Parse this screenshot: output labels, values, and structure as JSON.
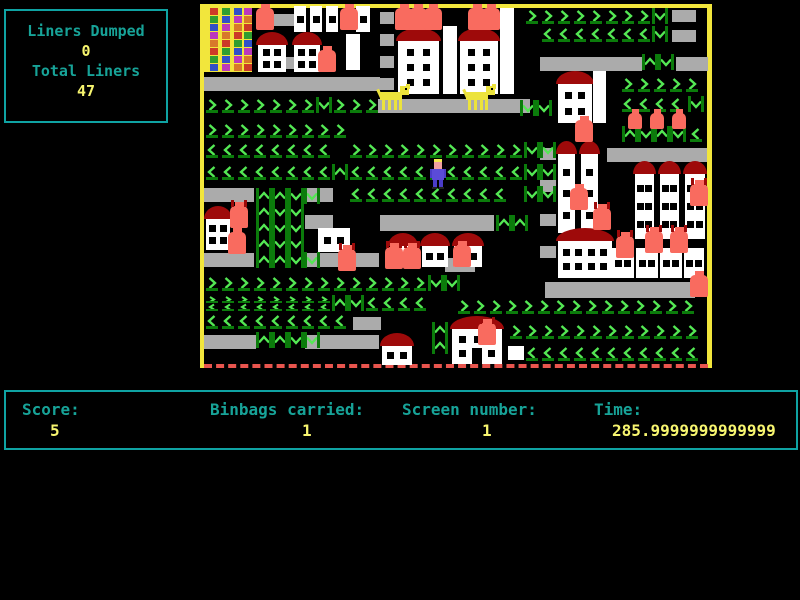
{
  "liners_panel": {
    "title": "Liners Dumped",
    "dumped": "0",
    "subtitle": "Total Liners",
    "total": "47"
  },
  "status_bar": {
    "score_label": "Score:",
    "score_value": "5",
    "binbags_label": "Binbags carried:",
    "binbags_value": "1",
    "screen_label": "Screen number:",
    "screen_value": "1",
    "time_label": "Time:",
    "time_value": "285.9999999999999"
  },
  "colors": {
    "border_yellow": "#F2E63C",
    "chevron": "#54E854",
    "chevron_dark": "#0B7B0B",
    "belt_gray": "#ABABAB",
    "house_white": "#FFFFFF",
    "roof_red": "#9E0A0A",
    "bin_salmon": "#F96B5F",
    "dog_yellow": "#ECE33C",
    "player_body": "#5B4BD8",
    "player_skin": "#F0A0A0",
    "panel_teal": "#0FA3A3",
    "label_teal": "#17A398",
    "value_yellow": "#F7F56F",
    "dash_red": "#E8554E"
  },
  "playfield": {
    "tower": {
      "x": 204,
      "y": 8,
      "w": 48,
      "h": 64,
      "block_colors": [
        "#CC3A28",
        "#2F9E30",
        "#3050C8",
        "#BC38BC",
        "#D8782A"
      ]
    },
    "belts": [
      [
        272,
        14,
        24,
        12
      ],
      [
        380,
        12,
        14,
        12
      ],
      [
        380,
        34,
        14,
        12
      ],
      [
        380,
        56,
        14,
        12
      ],
      [
        380,
        78,
        14,
        12
      ],
      [
        277,
        57,
        18,
        12
      ],
      [
        204,
        77,
        176,
        14
      ],
      [
        378,
        99,
        152,
        14
      ],
      [
        540,
        57,
        102,
        14
      ],
      [
        676,
        57,
        32,
        14
      ],
      [
        672,
        10,
        24,
        12
      ],
      [
        672,
        30,
        24,
        12
      ],
      [
        540,
        148,
        16,
        12
      ],
      [
        540,
        180,
        16,
        12
      ],
      [
        540,
        214,
        16,
        12
      ],
      [
        540,
        246,
        16,
        12
      ],
      [
        607,
        148,
        100,
        14
      ],
      [
        204,
        188,
        50,
        14
      ],
      [
        305,
        188,
        28,
        14
      ],
      [
        305,
        215,
        28,
        14
      ],
      [
        204,
        253,
        50,
        14
      ],
      [
        305,
        253,
        74,
        14
      ],
      [
        380,
        215,
        114,
        16
      ],
      [
        445,
        258,
        30,
        14
      ],
      [
        204,
        335,
        52,
        14
      ],
      [
        305,
        335,
        74,
        14
      ],
      [
        353,
        317,
        28,
        13
      ],
      [
        545,
        282,
        150,
        16
      ],
      [
        220,
        56,
        16,
        16
      ]
    ],
    "chevron_runs": [
      [
        ">",
        524,
        8,
        8
      ],
      [
        "v",
        652,
        8,
        1
      ],
      [
        "<",
        540,
        26,
        7
      ],
      [
        "v",
        652,
        26,
        1
      ],
      [
        "^",
        642,
        54,
        1
      ],
      [
        "v",
        658,
        54,
        1
      ],
      [
        ">",
        620,
        76,
        5
      ],
      [
        "<",
        620,
        96,
        4
      ],
      [
        "v",
        688,
        96,
        1
      ],
      [
        "^",
        622,
        126,
        1
      ],
      [
        "v",
        638,
        126,
        1
      ],
      [
        "^",
        654,
        126,
        1
      ],
      [
        "v",
        670,
        126,
        1
      ],
      [
        "<",
        688,
        126,
        1
      ],
      [
        ">",
        204,
        97,
        7
      ],
      [
        "v",
        316,
        97,
        1
      ],
      [
        ">",
        332,
        97,
        3
      ],
      [
        ">",
        204,
        122,
        9
      ],
      [
        "<",
        204,
        142,
        8
      ],
      [
        ">",
        348,
        142,
        11
      ],
      [
        "v",
        524,
        142,
        1
      ],
      [
        "v",
        540,
        142,
        1
      ],
      [
        "<",
        204,
        164,
        8
      ],
      [
        "^",
        332,
        164,
        1
      ],
      [
        "<",
        348,
        164,
        11
      ],
      [
        "v",
        524,
        164,
        1
      ],
      [
        "v",
        540,
        164,
        1
      ],
      [
        "<",
        348,
        186,
        10
      ],
      [
        "v",
        524,
        186,
        1
      ],
      [
        "v",
        540,
        186,
        1
      ],
      [
        "^",
        256,
        188,
        1
      ],
      [
        "^",
        272,
        188,
        1
      ],
      [
        "v",
        288,
        188,
        1
      ],
      [
        "v",
        304,
        188,
        1
      ],
      [
        "^",
        256,
        204,
        1
      ],
      [
        "v",
        272,
        204,
        1
      ],
      [
        "v",
        288,
        204,
        1
      ],
      [
        "^",
        256,
        220,
        1
      ],
      [
        "v",
        272,
        220,
        1
      ],
      [
        "v",
        288,
        220,
        1
      ],
      [
        "^",
        256,
        236,
        1
      ],
      [
        "v",
        272,
        236,
        1
      ],
      [
        "v",
        288,
        236,
        1
      ],
      [
        "^",
        256,
        252,
        1
      ],
      [
        "^",
        272,
        252,
        1
      ],
      [
        "v",
        288,
        252,
        1
      ],
      [
        "v",
        304,
        252,
        1
      ],
      [
        "^",
        496,
        215,
        1
      ],
      [
        "^",
        512,
        215,
        1
      ],
      [
        "v",
        520,
        100,
        1
      ],
      [
        "v",
        536,
        100,
        1
      ],
      [
        ">",
        204,
        275,
        14
      ],
      [
        "v",
        428,
        275,
        1
      ],
      [
        "v",
        444,
        275,
        1
      ],
      [
        "x",
        204,
        295,
        8
      ],
      [
        "^",
        332,
        295,
        1
      ],
      [
        "v",
        348,
        295,
        1
      ],
      [
        "<",
        364,
        295,
        4
      ],
      [
        ">",
        456,
        298,
        15
      ],
      [
        "<",
        204,
        313,
        9
      ],
      [
        ">",
        508,
        323,
        12
      ],
      [
        "<",
        524,
        345,
        11
      ],
      [
        "^",
        256,
        332,
        1
      ],
      [
        "^",
        272,
        332,
        1
      ],
      [
        "v",
        288,
        332,
        1
      ],
      [
        "v",
        304,
        332,
        1
      ],
      [
        "^",
        432,
        322,
        1
      ],
      [
        "^",
        432,
        338,
        1
      ]
    ],
    "houses": [
      {
        "x": 256,
        "y": 32,
        "w": 32,
        "h": 40,
        "roof": 1,
        "wr": 2,
        "wc": 2
      },
      {
        "x": 292,
        "y": 32,
        "w": 30,
        "h": 40,
        "roof": 1,
        "wr": 2,
        "wc": 2
      },
      {
        "x": 396,
        "y": 28,
        "w": 45,
        "h": 66,
        "roof": 1,
        "wr": 3,
        "wc": 2
      },
      {
        "x": 458,
        "y": 28,
        "w": 42,
        "h": 66,
        "roof": 1,
        "wr": 3,
        "wc": 2
      },
      {
        "x": 556,
        "y": 71,
        "w": 38,
        "h": 52,
        "roof": 1,
        "wr": 2,
        "wc": 2
      },
      {
        "x": 556,
        "y": 141,
        "w": 21,
        "h": 92,
        "roof": 1,
        "wr": 3,
        "wc": 1
      },
      {
        "x": 579,
        "y": 141,
        "w": 21,
        "h": 92,
        "roof": 1,
        "wr": 3,
        "wc": 1
      },
      {
        "x": 633,
        "y": 161,
        "w": 23,
        "h": 78,
        "roof": 1,
        "wr": 3,
        "wc": 2
      },
      {
        "x": 658,
        "y": 161,
        "w": 23,
        "h": 78,
        "roof": 1,
        "wr": 3,
        "wc": 2
      },
      {
        "x": 683,
        "y": 161,
        "w": 24,
        "h": 78,
        "roof": 1,
        "wr": 3,
        "wc": 2
      },
      {
        "x": 204,
        "y": 206,
        "w": 28,
        "h": 44,
        "roof": 1,
        "wr": 2,
        "wc": 2
      },
      {
        "x": 388,
        "y": 233,
        "w": 30,
        "h": 34,
        "roof": 1,
        "wr": 1,
        "wc": 2
      },
      {
        "x": 420,
        "y": 233,
        "w": 30,
        "h": 34,
        "roof": 1,
        "wr": 1,
        "wc": 2
      },
      {
        "x": 452,
        "y": 233,
        "w": 32,
        "h": 34,
        "roof": 1,
        "wr": 1,
        "wc": 2
      },
      {
        "x": 556,
        "y": 228,
        "w": 58,
        "h": 50,
        "roof": 1,
        "wr": 2,
        "wc": 4
      },
      {
        "x": 612,
        "y": 248,
        "w": 22,
        "h": 30,
        "roof": 0,
        "wr": 1,
        "wc": 2
      },
      {
        "x": 636,
        "y": 248,
        "w": 22,
        "h": 30,
        "roof": 0,
        "wr": 1,
        "wc": 2
      },
      {
        "x": 660,
        "y": 248,
        "w": 22,
        "h": 30,
        "roof": 0,
        "wr": 1,
        "wc": 2
      },
      {
        "x": 684,
        "y": 248,
        "w": 20,
        "h": 30,
        "roof": 0,
        "wr": 1,
        "wc": 2
      },
      {
        "x": 380,
        "y": 333,
        "w": 34,
        "h": 32,
        "roof": 1,
        "wr": 1,
        "wc": 2
      },
      {
        "x": 450,
        "y": 316,
        "w": 54,
        "h": 48,
        "roof": 1,
        "wr": 2,
        "wc": 3,
        "door": 1
      },
      {
        "x": 318,
        "y": 228,
        "w": 32,
        "h": 24,
        "roof": 0,
        "wr": 1,
        "wc": 2
      },
      {
        "x": 294,
        "y": 6,
        "w": 12,
        "h": 26,
        "roof": 0,
        "wr": 1,
        "wc": 1
      },
      {
        "x": 310,
        "y": 6,
        "w": 12,
        "h": 26,
        "roof": 0,
        "wr": 1,
        "wc": 1
      },
      {
        "x": 326,
        "y": 6,
        "w": 12,
        "h": 26,
        "roof": 0,
        "wr": 1,
        "wc": 1
      },
      {
        "x": 356,
        "y": 6,
        "w": 14,
        "h": 26,
        "roof": 0,
        "wr": 1,
        "wc": 1
      },
      {
        "x": 346,
        "y": 34,
        "w": 14,
        "h": 36,
        "roof": 0,
        "wr": 0,
        "wc": 0
      },
      {
        "x": 443,
        "y": 26,
        "w": 14,
        "h": 68,
        "roof": 0,
        "wr": 0,
        "wc": 0
      },
      {
        "x": 500,
        "y": 8,
        "w": 14,
        "h": 86,
        "roof": 0,
        "wr": 0,
        "wc": 0
      },
      {
        "x": 593,
        "y": 71,
        "w": 13,
        "h": 52,
        "roof": 0,
        "wr": 0,
        "wc": 0
      },
      {
        "x": 508,
        "y": 346,
        "w": 16,
        "h": 14,
        "roof": 0,
        "wr": 0,
        "wc": 0
      }
    ],
    "bins": [
      [
        256,
        8,
        0
      ],
      [
        340,
        8,
        0
      ],
      [
        395,
        8,
        0
      ],
      [
        409,
        8,
        0
      ],
      [
        424,
        8,
        0
      ],
      [
        468,
        8,
        0
      ],
      [
        482,
        8,
        0
      ],
      [
        318,
        50,
        0
      ],
      [
        575,
        120,
        0
      ],
      [
        628,
        113,
        0,
        14,
        16
      ],
      [
        650,
        113,
        0,
        14,
        16
      ],
      [
        672,
        113,
        0,
        14,
        16
      ],
      [
        690,
        184,
        1
      ],
      [
        570,
        188,
        0
      ],
      [
        593,
        208,
        1
      ],
      [
        616,
        236,
        1
      ],
      [
        645,
        231,
        1
      ],
      [
        670,
        231,
        1
      ],
      [
        230,
        206,
        1
      ],
      [
        228,
        232,
        0
      ],
      [
        338,
        249,
        1
      ],
      [
        385,
        247,
        1
      ],
      [
        403,
        247,
        1
      ],
      [
        453,
        245,
        1
      ],
      [
        478,
        323,
        1
      ],
      [
        690,
        275,
        0
      ]
    ],
    "dogs": [
      [
        378,
        84
      ],
      [
        464,
        84
      ]
    ],
    "player": {
      "x": 430,
      "y": 159
    }
  }
}
